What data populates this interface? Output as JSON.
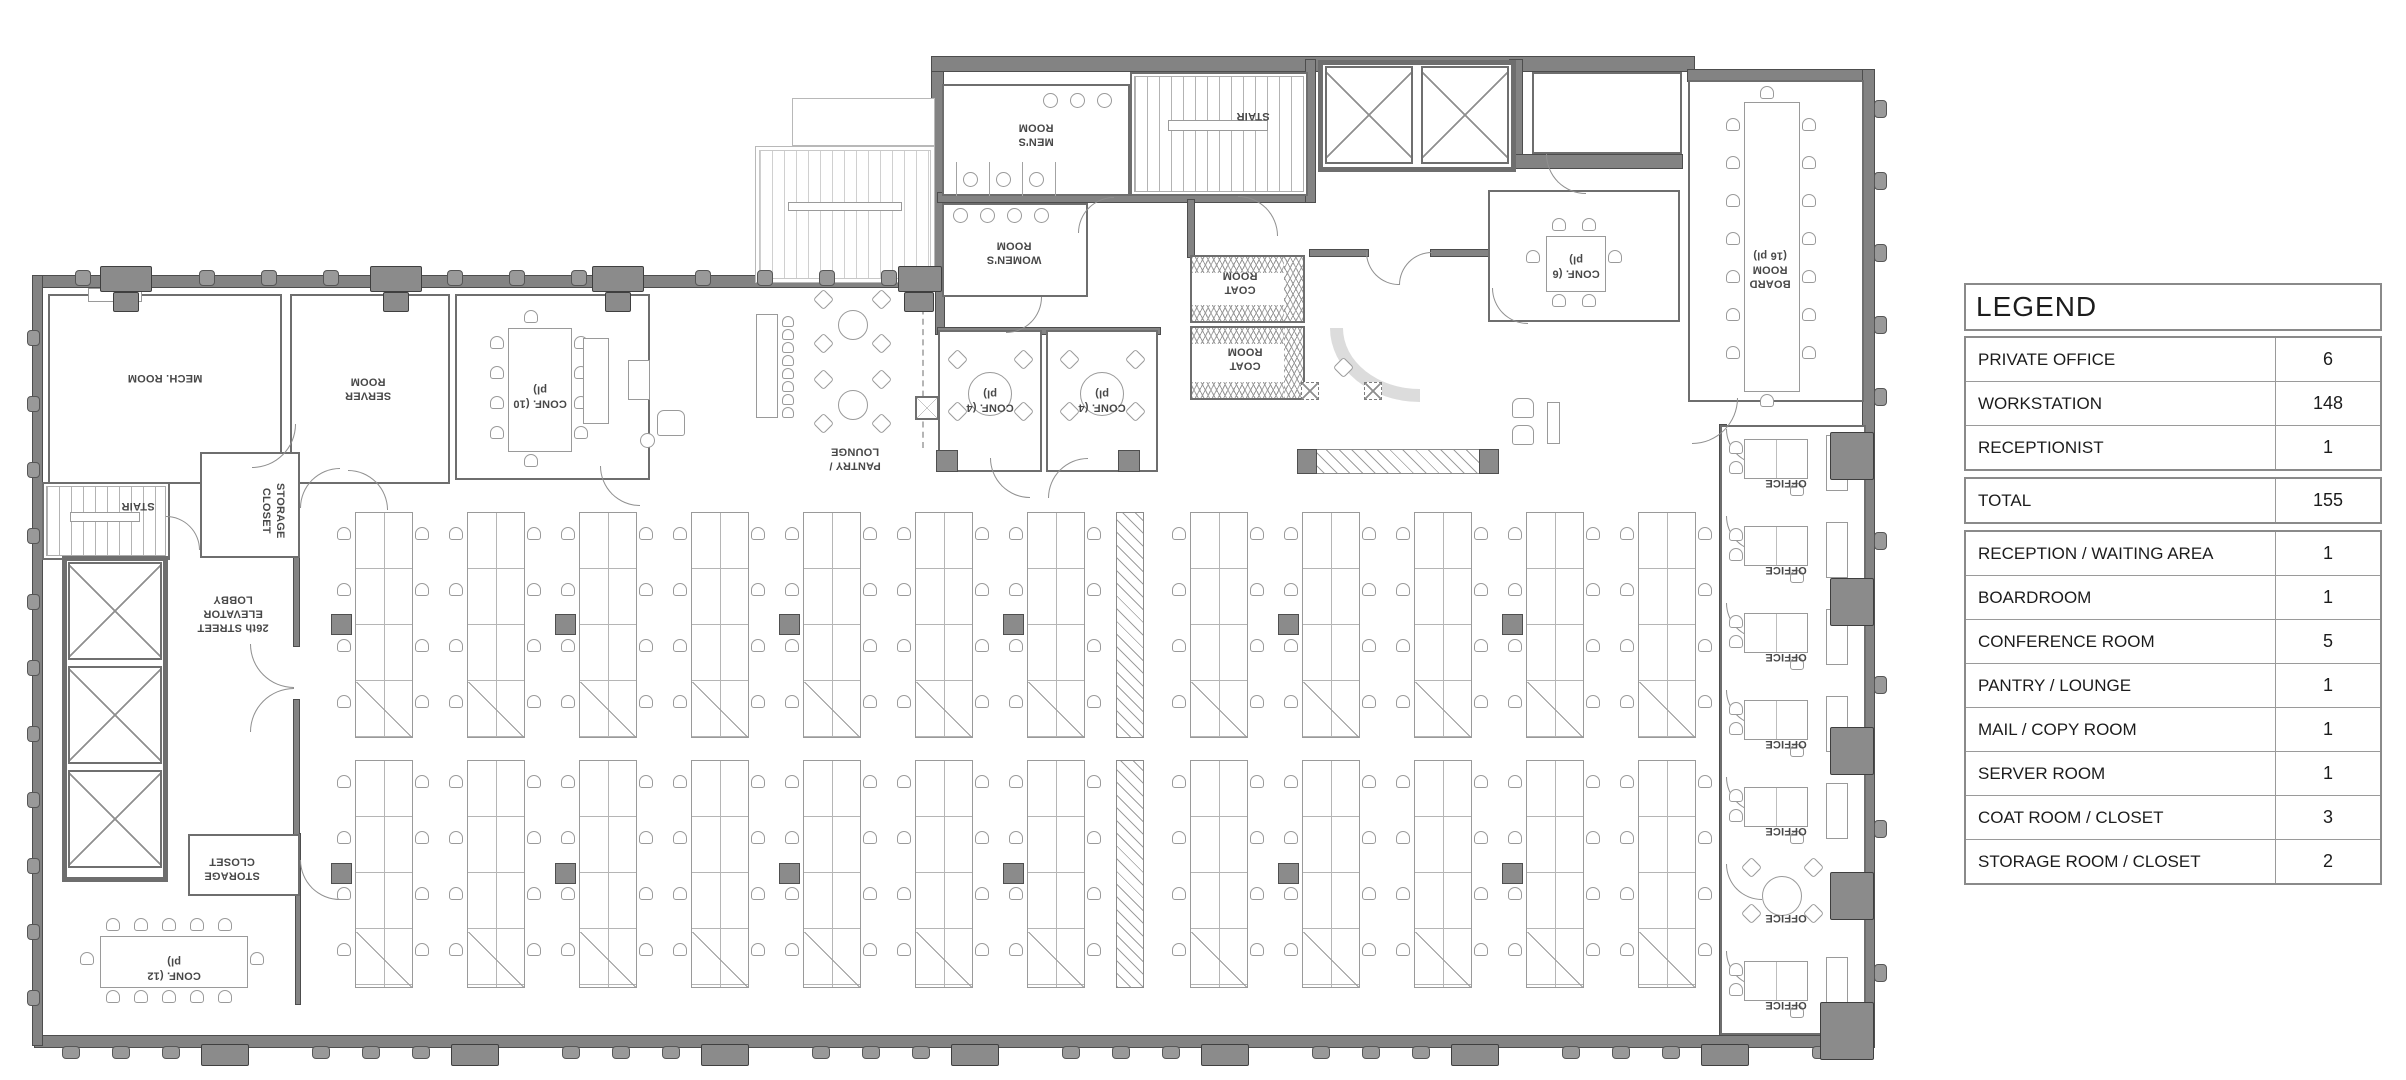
{
  "legend": {
    "title": "LEGEND",
    "rows": [
      {
        "label": "PRIVATE OFFICE",
        "value": "6"
      },
      {
        "label": "WORKSTATION",
        "value": "148"
      },
      {
        "label": "RECEPTIONIST",
        "value": "1"
      },
      {
        "label": "TOTAL",
        "value": "155"
      },
      {
        "label": "RECEPTION / WAITING AREA",
        "value": "1"
      },
      {
        "label": "BOARDROOM",
        "value": "1"
      },
      {
        "label": "CONFERENCE ROOM",
        "value": "5"
      },
      {
        "label": "PANTRY / LOUNGE",
        "value": "1"
      },
      {
        "label": "MAIL / COPY ROOM",
        "value": "1"
      },
      {
        "label": "SERVER ROOM",
        "value": "1"
      },
      {
        "label": "COAT ROOM / CLOSET",
        "value": "3"
      },
      {
        "label": "STORAGE ROOM / CLOSET",
        "value": "2"
      }
    ]
  },
  "plan": {
    "labels": {
      "mech_room": "MECH. ROOM",
      "server_room": "SERVER ROOM",
      "conf_10": "CONF. (10 pl)",
      "conf_12": "CONF. (12 pl)",
      "conf_6": "CONF. (6 pl)",
      "conf_4": "CONF. (4 pl)",
      "board_room": "BOARD ROOM (16 pl)",
      "pantry_lounge": "PANTRY / LOUNGE",
      "mens_room": "MEN'S ROOM",
      "womens_room": "WOMEN'S ROOM",
      "stair": "STAIR",
      "coat_room": "COAT ROOM",
      "storage_closet": "STORAGE CLOSET",
      "elevator_lobby": "26th STREET ELEVATOR LOBBY",
      "office": "OFFICE"
    }
  }
}
